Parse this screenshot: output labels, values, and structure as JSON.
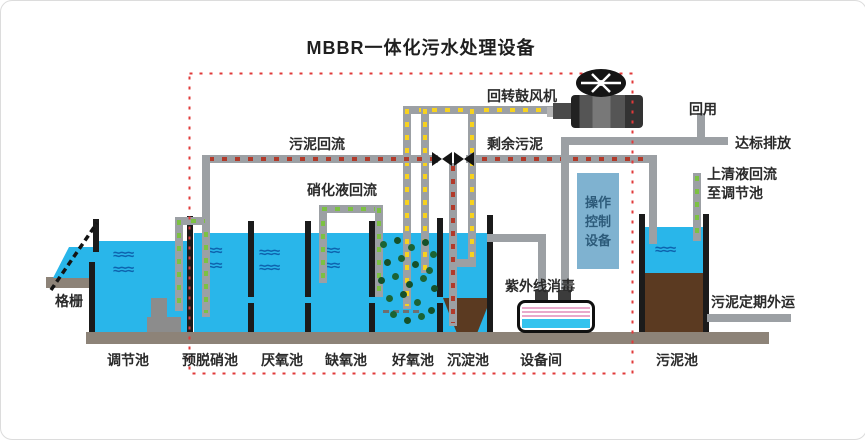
{
  "title": "MBBR一体化污水处理设备",
  "labels": {
    "screen": "格栅",
    "blower": "回转鼓风机",
    "sludge_return": "污泥回流",
    "nitrified_recycle": "硝化液回流",
    "excess_sludge": "剩余污泥",
    "reuse": "回用",
    "discharge": "达标排放",
    "supernatant_return_line1": "上清液回流",
    "supernatant_return_line2": "至调节池",
    "uv_disinfection": "紫外线消毒",
    "control_equipment": [
      "操作",
      "控制",
      "设备"
    ],
    "sludge_removal": "污泥定期外运"
  },
  "tanks": [
    {
      "label": "调节池"
    },
    {
      "label": "预脱硝池"
    },
    {
      "label": "厌氧池"
    },
    {
      "label": "缺氧池"
    },
    {
      "label": "好氧池"
    },
    {
      "label": "沉淀池"
    },
    {
      "label": "设备间"
    },
    {
      "label": "污泥池"
    }
  ],
  "icons": {
    "wave": "≈≈≈",
    "wave_short": "≈≈"
  },
  "colors": {
    "water": "#29b6ea",
    "sludge_brown": "#5b3a21",
    "pipe_gray": "#9ca0a4",
    "wall_black": "#1b1b1b",
    "dashed_border_red": "#e03a3a",
    "air_dash_yellow": "#f7d21e",
    "sludge_dash_red": "#b23a2a",
    "liquid_dash_green": "#7cc142",
    "control_box_blue": "#7fb2d0"
  }
}
